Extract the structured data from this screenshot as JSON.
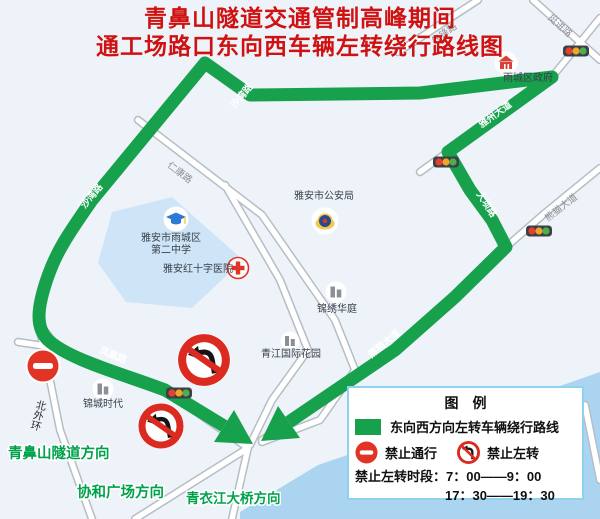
{
  "title": {
    "line1": "青鼻山隧道交通管制高峰期间",
    "line2": "通工场路口东向西车辆左转绕行路线图"
  },
  "map": {
    "road_labels": {
      "xianfeng": "先锋路",
      "tingjin": "挺进路",
      "yazhou": "雅州大道",
      "daba": "大坝路",
      "xiongmao_ne": "熊猫大道",
      "xiongmao_sw": "熊猫大道",
      "shawan_upper": "沙湾路",
      "shawan_lower": "沙湾路",
      "fenghuang": "凤凰路",
      "renkang": "仁康路",
      "beiwaihuan": "北外环"
    },
    "pois": {
      "district_gov": "雨城区政府",
      "police": "雅安市公安局",
      "school_line1": "雅安市雨城区",
      "school_line2": "第二中学",
      "hospital": "雅安红十字医院",
      "jinxiu_huating": "锦绣华庭",
      "qingjiang_garden": "青江国际花园",
      "jincheng_era": "锦城时代"
    },
    "directions": {
      "tunnel": "青鼻山隧道方向",
      "plaza": "协和广场方向",
      "bridge": "青衣江大桥方向"
    }
  },
  "legend": {
    "title": "图　例",
    "route": "东向西方向左转车辆绕行路线",
    "no_entry": "禁止通行",
    "no_left_turn": "禁止左转",
    "time_line1": "禁止左转时段：7：00——9：00",
    "time_line2": "17：30——19：30"
  },
  "colors": {
    "route_green": "#18a14d",
    "sign_red": "#e23424",
    "title_red": "#cf1211",
    "direction_green": "#00a14b",
    "water_blue": "#abd4f0"
  }
}
